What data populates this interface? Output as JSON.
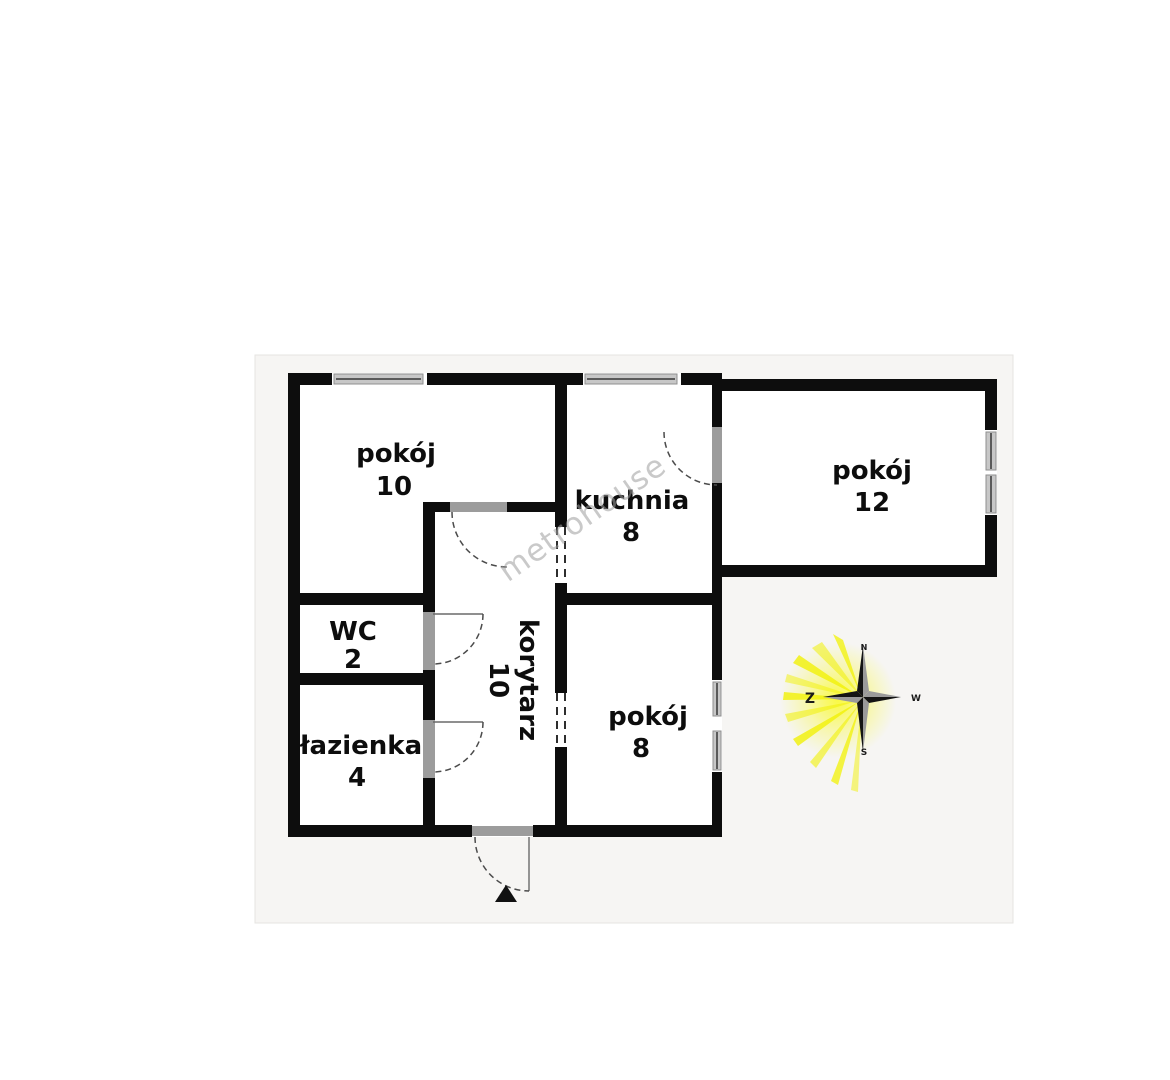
{
  "title": "apartment-floor-plan",
  "watermark": "metrohouse",
  "rooms": [
    {
      "name": "pokój",
      "area": "10"
    },
    {
      "name": "kuchnia",
      "area": "8"
    },
    {
      "name": "pokój",
      "area": "12"
    },
    {
      "name": "WC",
      "area": "2"
    },
    {
      "name": "łazienka",
      "area": "4"
    },
    {
      "name": "pokój",
      "area": "8"
    },
    {
      "name": "korytarz",
      "area": "10"
    }
  ],
  "compass": {
    "north": "N",
    "east": "W",
    "south": "S",
    "west": "Z"
  },
  "colors": {
    "wall": "#0d0d0d",
    "room_fill": "#ffffff",
    "canvas": "#f6f5f3",
    "window": "#c7c7c7",
    "door": "#9c9c9c",
    "glow": "#f1f106",
    "star_gray": "#9a9a9a",
    "watermark_gray": "#9e9e9e"
  }
}
